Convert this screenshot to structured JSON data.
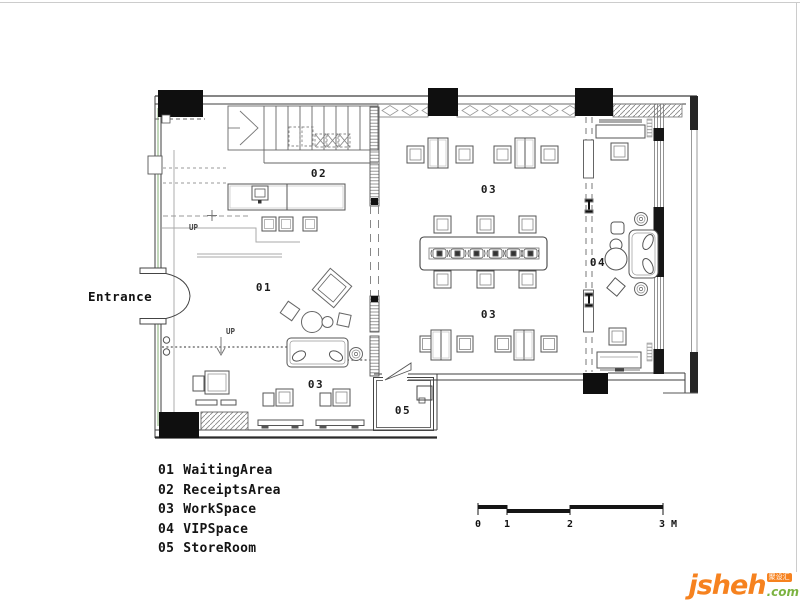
{
  "plan": {
    "entrance_label": "Entrance",
    "up_label_1": "UP",
    "up_label_2": "UP",
    "rooms": {
      "waiting": {
        "code": "01"
      },
      "receipts": {
        "code": "02"
      },
      "work_upper": {
        "code": "03"
      },
      "work_lower": {
        "code": "03"
      },
      "work_south": {
        "code": "03"
      },
      "vip": {
        "code": "04"
      },
      "store": {
        "code": "05"
      }
    }
  },
  "legend": {
    "items": [
      {
        "code": "01",
        "name": "WaitingArea"
      },
      {
        "code": "02",
        "name": "ReceiptsArea"
      },
      {
        "code": "03",
        "name": "WorkSpace"
      },
      {
        "code": "04",
        "name": "VIPSpace"
      },
      {
        "code": "05",
        "name": "StoreRoom"
      }
    ]
  },
  "scale_bar": {
    "ticks": [
      "0",
      "1",
      "2",
      "3 M"
    ]
  },
  "logo": {
    "name": "jsheh",
    "tld": ".com",
    "badge": "聚设汇"
  },
  "colors": {
    "wall": "#3f3f3f",
    "column": "#0f0f0f",
    "accent_green": "#a9c79e",
    "logo_orange": "#f6821f",
    "logo_green": "#7cb342"
  }
}
